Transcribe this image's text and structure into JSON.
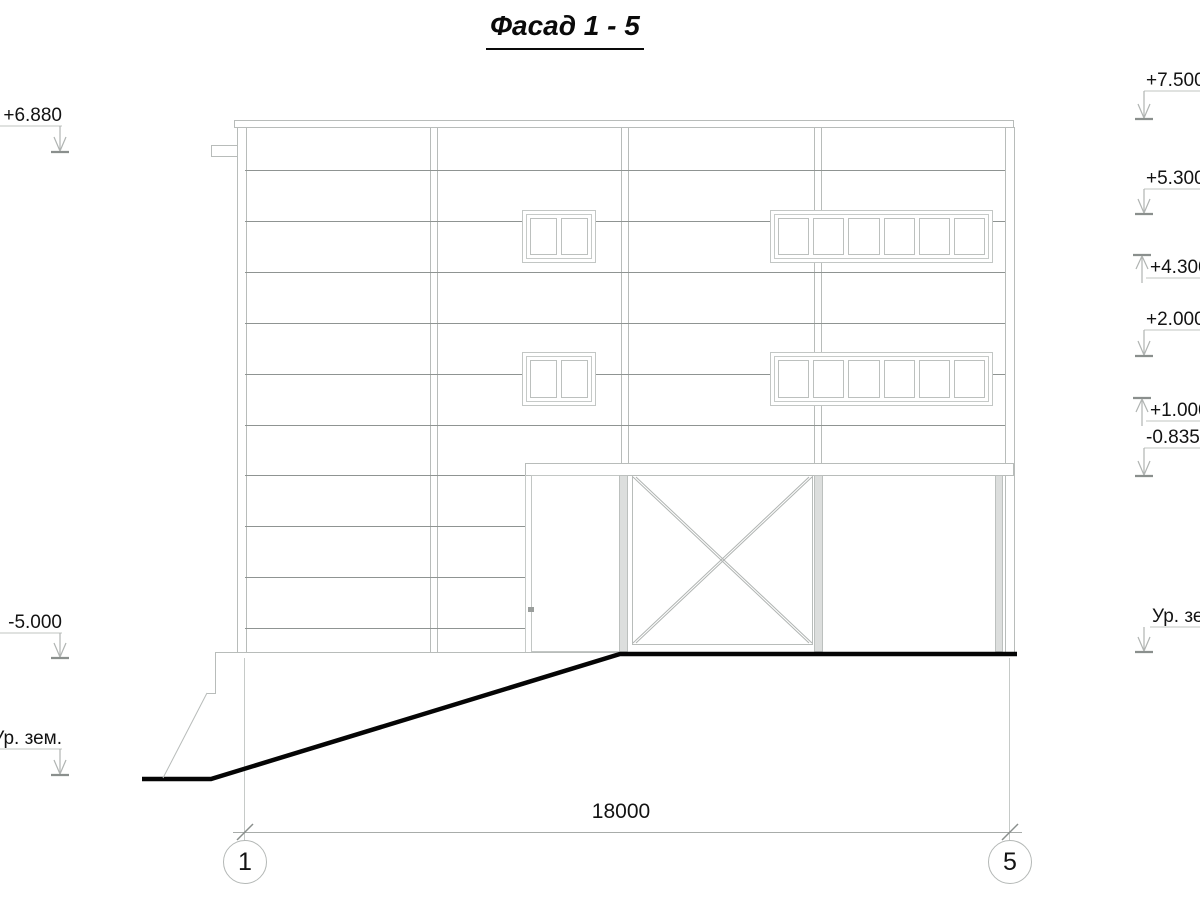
{
  "title": "Фасад 1 - 5",
  "levels_left": [
    {
      "label": "+6.880"
    },
    {
      "label": "-5.000"
    },
    {
      "label": "Ур. зем."
    }
  ],
  "levels_right": [
    {
      "label": "+7.500"
    },
    {
      "label": "+5.300"
    },
    {
      "label": "+4.300"
    },
    {
      "label": "+2.000"
    },
    {
      "label": "+1.000"
    },
    {
      "label": "-0.835"
    },
    {
      "label": "Ур. зем."
    }
  ],
  "dimension": {
    "overall_length": "18000",
    "axis_start": "1",
    "axis_end": "5"
  },
  "colors": {
    "thin_line": "#b8bcba",
    "siding_line": "#8f9492",
    "ground_line": "#050505",
    "text": "#111111"
  }
}
